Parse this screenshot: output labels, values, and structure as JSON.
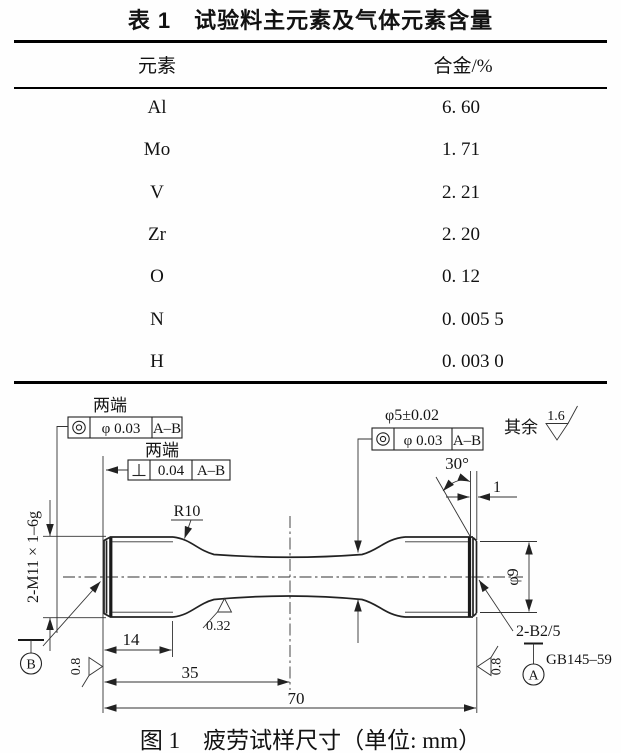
{
  "table": {
    "title": "表 1　试验料主元素及气体元素含量",
    "columns": {
      "element": "元素",
      "content": "合金/%"
    },
    "rows": [
      {
        "element": "Al",
        "value": "6. 60"
      },
      {
        "element": "Mo",
        "value": "1. 71"
      },
      {
        "element": "V",
        "value": "2. 21"
      },
      {
        "element": "Zr",
        "value": "2. 20"
      },
      {
        "element": "O",
        "value": "0. 12"
      },
      {
        "element": "N",
        "value": "0. 005 5"
      },
      {
        "element": "H",
        "value": "0. 003 0"
      }
    ]
  },
  "figure": {
    "caption": "图 1　疲劳试样尺寸（单位: mm）",
    "frames": [
      {
        "note": "两端",
        "symbol": "◎",
        "tolerance": "φ 0.03",
        "datum": "A–B"
      },
      {
        "note": "两端",
        "symbol": "⊥",
        "tolerance": "0.04",
        "datum": "A–B"
      },
      {
        "note": "φ5±0.02",
        "symbol": "◎",
        "tolerance": "φ 0.03",
        "datum": "A–B"
      }
    ],
    "surface_finish": {
      "general_note": "其余",
      "general_value": "1.6",
      "gauge_value": "0.32",
      "left_end_value": "0.8",
      "right_end_value": "0.8"
    },
    "labels": {
      "fillet_radius": "R10",
      "thread": "2-M11 × 1–6g",
      "chamfer_angle": "30°",
      "chamfer_length": "1",
      "end_diameter": "φ9",
      "center_hole": "2-B2/5",
      "center_hole_standard": "GB145–59"
    },
    "datums": {
      "a": "A",
      "b": "B"
    },
    "dimensions": {
      "grip_length": "14",
      "half_length": "35",
      "total_length": "70"
    }
  }
}
